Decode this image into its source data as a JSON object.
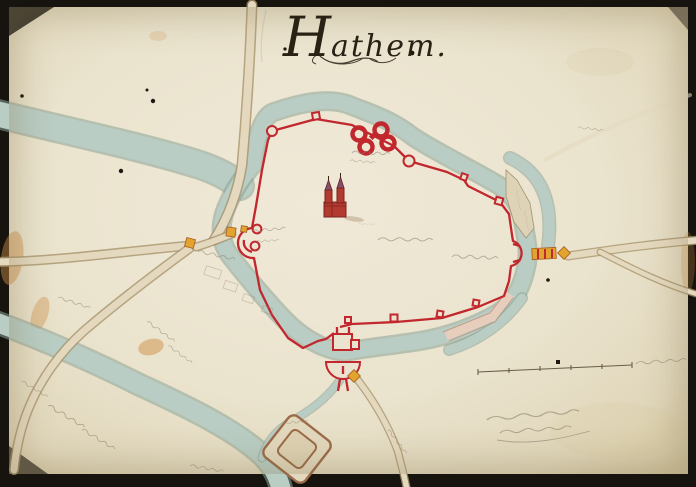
{
  "title": {
    "text": "Hathem."
  },
  "colors": {
    "frame": "#17140f",
    "paper": "#eae3cf",
    "paper_edge": "#d6cbab",
    "water": "#b9cdc4",
    "water_edge": "#8ba295",
    "road": "#e4d9bf",
    "road_edge": "#a8946b",
    "wall": "#c1272d",
    "orange": "#e2a42e",
    "church": "#b23a30",
    "ink": "#2a2115",
    "pencil": "#8d8170",
    "stain": "#cf8f45",
    "outwork": "#ded3b6",
    "outwork_edge": "#a69a79",
    "se_outwork": "#e7cdbb",
    "se_outwork_edge": "#bb9179",
    "fort_brown": "#9b6b4a"
  },
  "features": [
    "walled-town-outline",
    "moat",
    "church",
    "north-twin-gates",
    "west-gate-barbican",
    "east-gate-bridge",
    "south-gate-ravelin",
    "ne-outwork",
    "se-outwork",
    "square-fort",
    "upper-river",
    "lower-river",
    "roads",
    "scale-bar",
    "handwritten-annotations",
    "archival-note",
    "ink-specks",
    "stains"
  ]
}
